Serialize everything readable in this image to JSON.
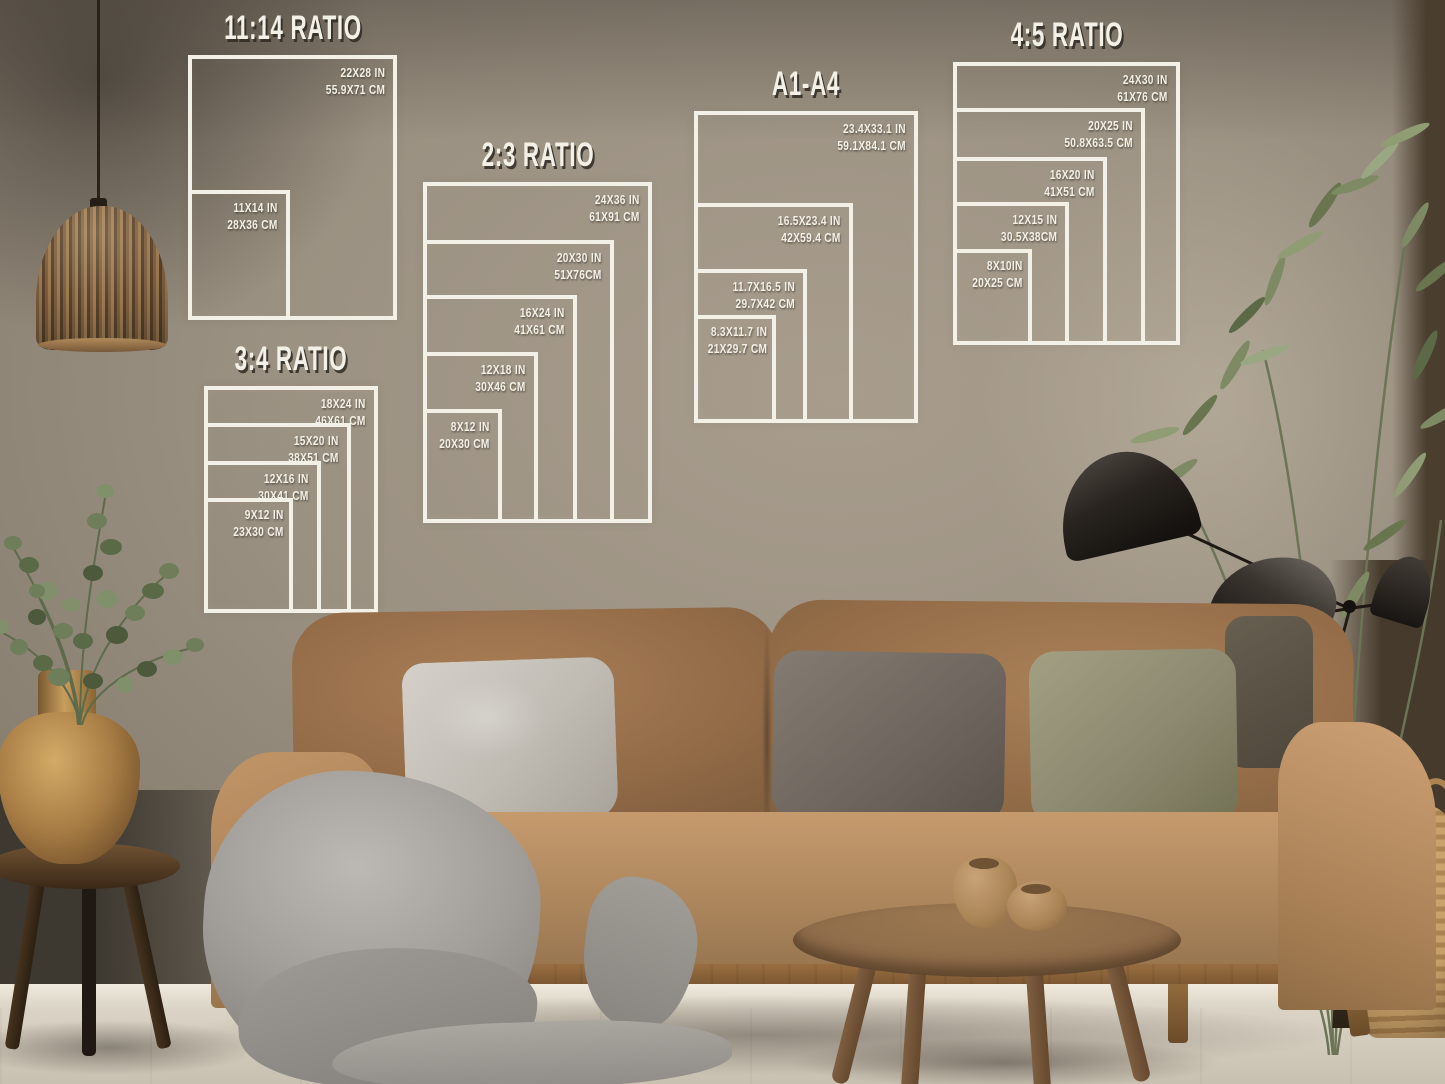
{
  "meta": {
    "scene_description": "Living room photo mockup with five white poster frame size-ratio guides drawn on the wall above a camel sofa"
  },
  "colors": {
    "frame_line": "#f3f0e7",
    "wall": "#9b9182",
    "sofa_camel": "#b38b61",
    "pillow_light_gray": "#c9c4bc",
    "pillow_dark_gray": "#6d655d",
    "pillow_olive": "#8c8970",
    "blanket_gray": "#a3a09b",
    "wood_table": "#8a6847",
    "brass_vase": "#c89e5e",
    "plant_green": "#7d8a63",
    "lamp_black": "#1d1813",
    "floor": "#d4ccbd"
  },
  "size_charts": [
    {
      "title": "11:14 RATIO",
      "sizes": [
        {
          "inches": "22X28 IN",
          "cm": "55.9X71 CM"
        },
        {
          "inches": "11X14 IN",
          "cm": "28X36 CM"
        }
      ]
    },
    {
      "title": "2:3 RATIO",
      "sizes": [
        {
          "inches": "24X36 IN",
          "cm": "61X91 CM"
        },
        {
          "inches": "20X30 IN",
          "cm": "51X76CM"
        },
        {
          "inches": "16X24 IN",
          "cm": "41X61 CM"
        },
        {
          "inches": "12X18 IN",
          "cm": "30X46 CM"
        },
        {
          "inches": "8X12 IN",
          "cm": "20X30 CM"
        }
      ]
    },
    {
      "title": "A1-A4",
      "sizes": [
        {
          "inches": "23.4X33.1 IN",
          "cm": "59.1X84.1 CM"
        },
        {
          "inches": "16.5X23.4 IN",
          "cm": "42X59.4 CM"
        },
        {
          "inches": "11.7X16.5 IN",
          "cm": "29.7X42 CM"
        },
        {
          "inches": "8.3X11.7 IN",
          "cm": "21X29.7 CM"
        }
      ]
    },
    {
      "title": "4:5 RATIO",
      "sizes": [
        {
          "inches": "24X30 IN",
          "cm": "61X76 CM"
        },
        {
          "inches": "20X25 IN",
          "cm": "50.8X63.5 CM"
        },
        {
          "inches": "16X20 IN",
          "cm": "41X51 CM"
        },
        {
          "inches": "12X15 IN",
          "cm": "30.5X38CM"
        },
        {
          "inches": "8X10IN",
          "cm": "20X25 CM"
        }
      ]
    },
    {
      "title": "3:4 RATIO",
      "sizes": [
        {
          "inches": "18X24 IN",
          "cm": "46X61 CM"
        },
        {
          "inches": "15X20 IN",
          "cm": "38X51 CM"
        },
        {
          "inches": "12X16 IN",
          "cm": "30X41 CM"
        },
        {
          "inches": "9X12 IN",
          "cm": "23X30 CM"
        }
      ]
    }
  ]
}
